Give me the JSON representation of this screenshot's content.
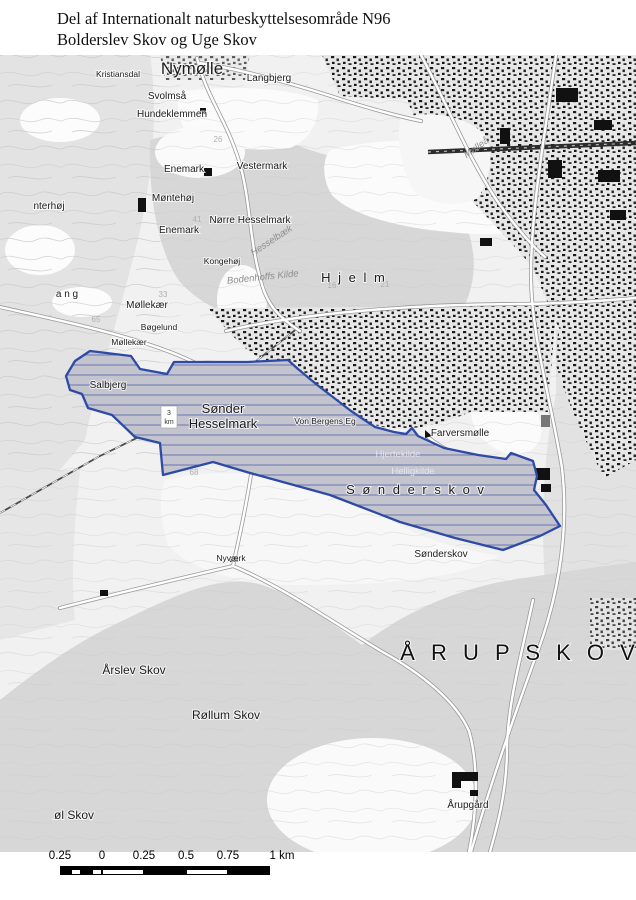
{
  "title": {
    "line1": "Del af Internationalt naturbeskyttelsesområde N96",
    "line2": "Bolderslev Skov og Uge Skov"
  },
  "map": {
    "boundary": {
      "name": "natura-2000-area-outline",
      "color": "#2d4ba6",
      "hatch_color": "#6b76b2",
      "path": "M90,351 L131,356 L140,369 L167,374 L174,362 L247,362 L288,360 L298,369 L316,384 L351,411 L375,427 L394,432 L406,434 L412,428 L418,436 L444,448 L478,455 L506,459 L511,453 L533,461 L537,476 L534,490 L546,505 L560,526 L540,536 L503,550 L455,538 L400,522 L330,495 L250,473 L213,462 L163,475 L160,443 L135,437 L112,415 L88,408 L82,394 L70,390 L66,376 L75,361 Z"
    },
    "km_marker": {
      "top": "3",
      "bottom": "km"
    },
    "labels": [
      {
        "t": "Kristiansdal",
        "x": 118,
        "y": 77,
        "c": "sm"
      },
      {
        "t": "Nymølle",
        "x": 192,
        "y": 74,
        "c": "big"
      },
      {
        "t": "Langbjerg",
        "x": 269,
        "y": 81,
        "c": "lbl"
      },
      {
        "t": "Svolmså",
        "x": 167,
        "y": 99,
        "c": "lbl"
      },
      {
        "t": "Hundeklemmen",
        "x": 172,
        "y": 117,
        "c": "lbl"
      },
      {
        "t": "Enemark",
        "x": 184,
        "y": 172,
        "c": "lbl"
      },
      {
        "t": "Vestermark",
        "x": 262,
        "y": 169,
        "c": "lbl"
      },
      {
        "t": "nterhøj",
        "x": 49,
        "y": 209,
        "c": "lbl"
      },
      {
        "t": "Møntehøj",
        "x": 173,
        "y": 201,
        "c": "lbl"
      },
      {
        "t": "Nørre Hesselmark",
        "x": 250,
        "y": 223,
        "c": "lbl"
      },
      {
        "t": "Enemark",
        "x": 179,
        "y": 233,
        "c": "lbl"
      },
      {
        "t": "Kongehøj",
        "x": 222,
        "y": 264,
        "c": "sm"
      },
      {
        "t": "Hesselbæk",
        "x": 273,
        "y": 243,
        "c": "it",
        "r": -33
      },
      {
        "t": "Bodenhoffs Kilde",
        "x": 263,
        "y": 280,
        "c": "it",
        "r": -6
      },
      {
        "t": "H j e l m",
        "x": 354,
        "y": 282,
        "c": "sp"
      },
      {
        "t": "a n g",
        "x": 67,
        "y": 297,
        "c": "lbl"
      },
      {
        "t": "Møllekær",
        "x": 147,
        "y": 308,
        "c": "lbl"
      },
      {
        "t": "Bøgelund",
        "x": 159,
        "y": 330,
        "c": "sm"
      },
      {
        "t": "Møllekær",
        "x": 129,
        "y": 345,
        "c": "sm"
      },
      {
        "t": "Salbjerg",
        "x": 108,
        "y": 388,
        "c": "lbl"
      },
      {
        "t": "Sønder",
        "x": 223,
        "y": 413,
        "c": "med"
      },
      {
        "t": "Hesselmark",
        "x": 223,
        "y": 428,
        "c": "med"
      },
      {
        "t": "Von Bergens Eg",
        "x": 325,
        "y": 424,
        "c": "sm"
      },
      {
        "t": "Farversmølle",
        "x": 460,
        "y": 436,
        "c": "lbl"
      },
      {
        "t": "Hjertekilde",
        "x": 398,
        "y": 457,
        "c": "wt"
      },
      {
        "t": "Helligkilde",
        "x": 413,
        "y": 474,
        "c": "wt"
      },
      {
        "t": "S ø n d e r s k o v",
        "x": 416,
        "y": 494,
        "c": "sp"
      },
      {
        "t": "Sønderskov",
        "x": 441,
        "y": 557,
        "c": "lbl"
      },
      {
        "t": "Nyværk",
        "x": 231,
        "y": 561,
        "c": "sm"
      },
      {
        "t": "Årslev Skov",
        "x": 134,
        "y": 674,
        "c": "md2"
      },
      {
        "t": "Å R U P   S K O V",
        "x": 520,
        "y": 660,
        "c": "hg"
      },
      {
        "t": "Røllum Skov",
        "x": 226,
        "y": 719,
        "c": "md2"
      },
      {
        "t": "Årupgård",
        "x": 468,
        "y": 808,
        "c": "lbl"
      },
      {
        "t": "øl Skov",
        "x": 74,
        "y": 819,
        "c": "md2"
      },
      {
        "t": "Mølleå",
        "x": 478,
        "y": 150,
        "c": "it",
        "r": -36
      },
      {
        "t": "41",
        "x": 197,
        "y": 222,
        "c": "num"
      },
      {
        "t": "26",
        "x": 218,
        "y": 142,
        "c": "num"
      },
      {
        "t": "65",
        "x": 96,
        "y": 322,
        "c": "num"
      },
      {
        "t": "33",
        "x": 163,
        "y": 297,
        "c": "num"
      },
      {
        "t": "68",
        "x": 194,
        "y": 475,
        "c": "num"
      },
      {
        "t": "16",
        "x": 332,
        "y": 288,
        "c": "num"
      },
      {
        "t": "21",
        "x": 385,
        "y": 287,
        "c": "num"
      }
    ]
  },
  "scalebar": {
    "tick_labels": [
      "0.25",
      "0",
      "0.25",
      "0.5",
      "0.75"
    ],
    "end_label": "1 km",
    "x0": 60,
    "segment_px": 42,
    "label_y": 850,
    "bar_y": 866
  }
}
